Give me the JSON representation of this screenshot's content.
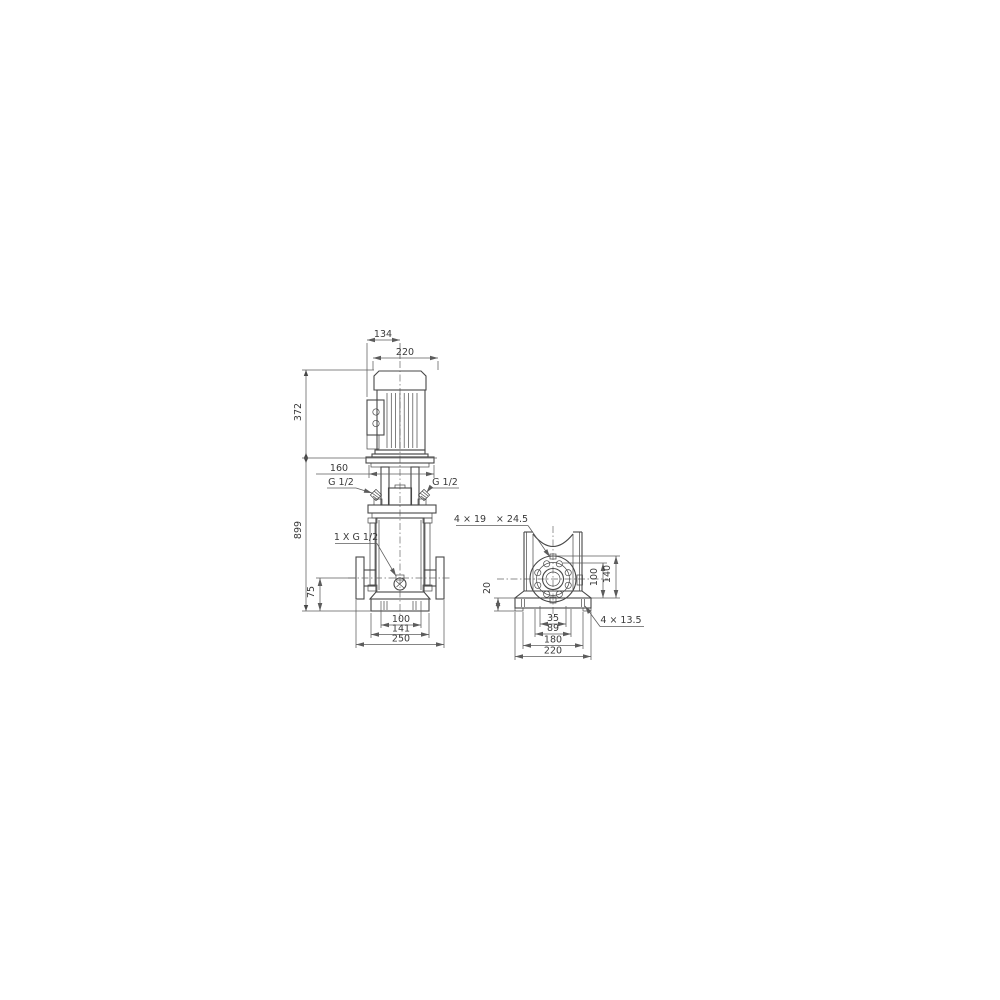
{
  "page": {
    "background": "#ffffff",
    "line_color": "#474747",
    "dim_color": "#5c5c5c",
    "text_color": "#3a3a3a"
  },
  "drawing": {
    "front_view": {
      "dim_134": "134",
      "dim_220": "220",
      "dim_372": "372",
      "dim_899": "899",
      "dim_160": "160",
      "port_left_label": "G 1/2",
      "port_right_label": "G 1/2",
      "drain_label": "1 X G 1/2",
      "dim_75": "75",
      "dim_100": "100",
      "dim_141": "141",
      "dim_250": "250"
    },
    "side_view": {
      "flange_holes_count": "4 × 19",
      "flange_holes_diameter": "× 24.5",
      "dim_20": "20",
      "dim_100": "100",
      "dim_140": "140",
      "dim_35": "35",
      "dim_89": "89",
      "dim_180": "180",
      "dim_220": "220",
      "base_holes_label": "4 × 13.5"
    }
  }
}
